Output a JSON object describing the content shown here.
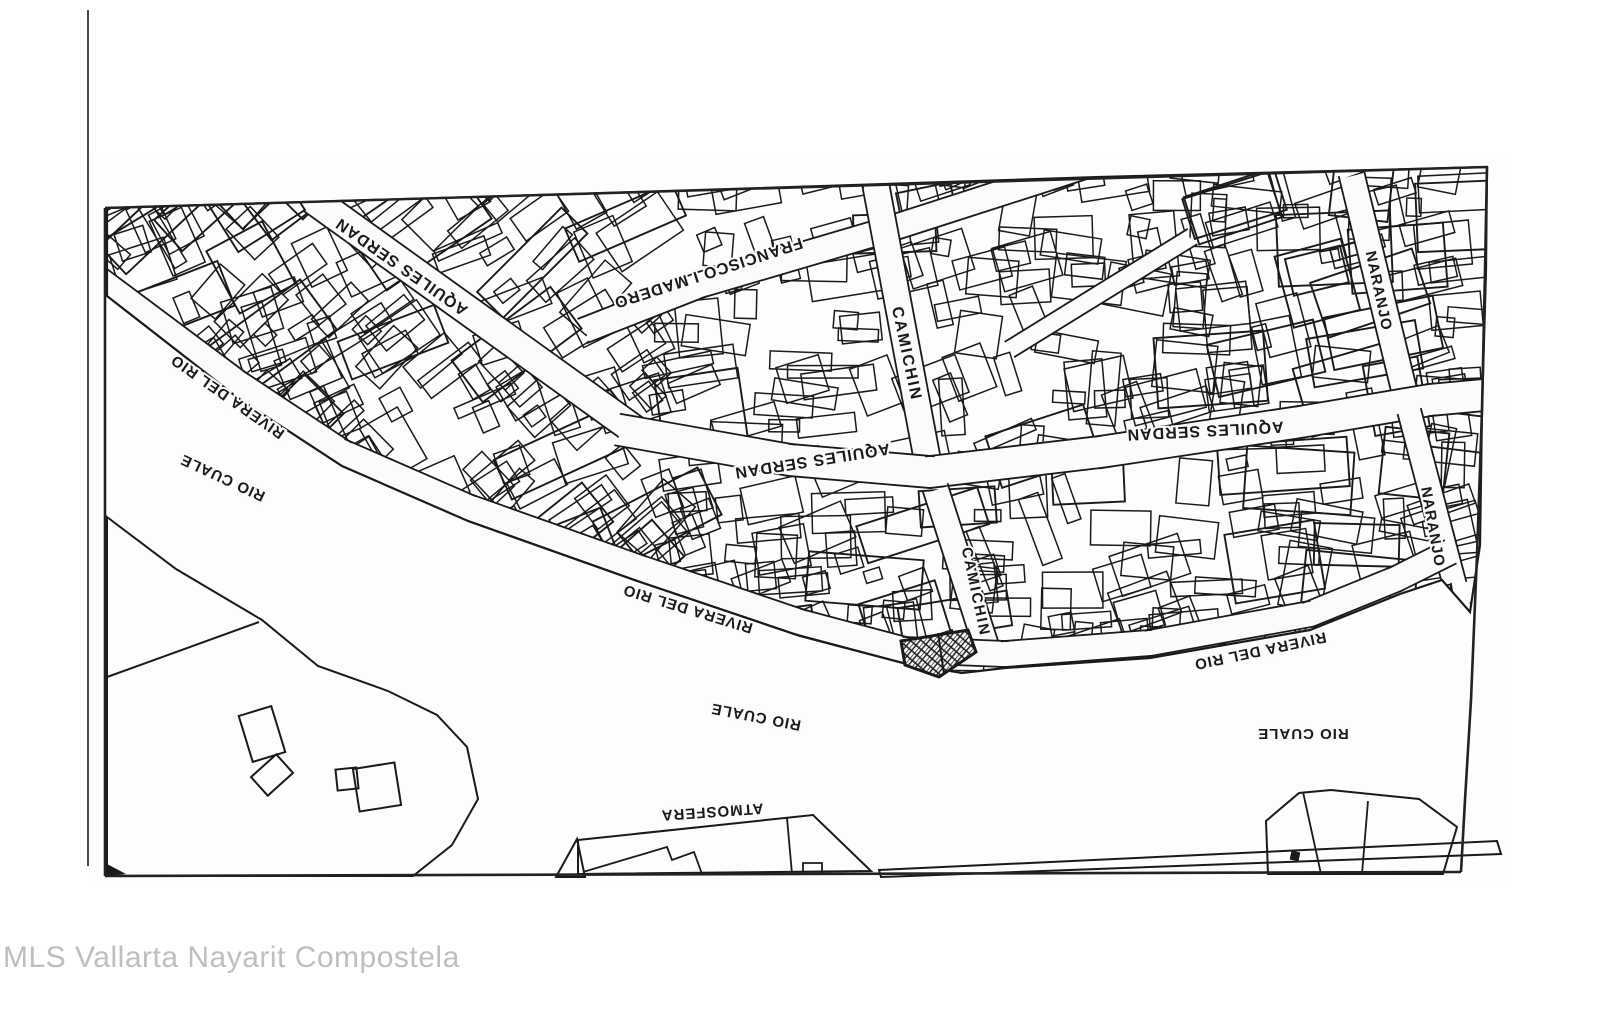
{
  "map": {
    "colors": {
      "ink": "#1a1a1a",
      "paper": "#fbfbfa",
      "frame": "#222222",
      "scan_edge": "#4a4a4a",
      "watermark": "#bfbfc1"
    },
    "watermark": {
      "text": "MLS Vallarta Nayarit Compostela"
    },
    "street_labels": [
      {
        "name": "aquiles-serdan-nw",
        "text": "AQUILES SERDAN",
        "x": 402,
        "y": 266,
        "rotation": 215,
        "size": 16,
        "spacing": 1
      },
      {
        "name": "francisco-i-madero",
        "text": "FRANCISCO I MADERO",
        "x": 708,
        "y": 272,
        "rotation": 162,
        "size": 16,
        "spacing": 1
      },
      {
        "name": "camichin-north",
        "text": "CAMICHIN",
        "x": 906,
        "y": 354,
        "rotation": 78,
        "size": 16,
        "spacing": 2
      },
      {
        "name": "aquiles-serdan-center",
        "text": "AQUILES SERDAN",
        "x": 812,
        "y": 460,
        "rotation": 171,
        "size": 16,
        "spacing": 1
      },
      {
        "name": "aquiles-serdan-east",
        "text": "AQUILES SERDAN",
        "x": 1205,
        "y": 430,
        "rotation": 177,
        "size": 16,
        "spacing": 1
      },
      {
        "name": "naranjo-north",
        "text": "NARANJO",
        "x": 1378,
        "y": 291,
        "rotation": 78,
        "size": 15,
        "spacing": 1
      },
      {
        "name": "naranjo-south",
        "text": "NARANJO",
        "x": 1432,
        "y": 527,
        "rotation": 80,
        "size": 15,
        "spacing": 1
      },
      {
        "name": "rivera-del-rio-west",
        "text": "RIVERA DEL RIO",
        "x": 228,
        "y": 396,
        "rotation": 215,
        "size": 15,
        "spacing": 1
      },
      {
        "name": "rio-cuale-west",
        "text": "RIO CUALE",
        "x": 223,
        "y": 477,
        "rotation": 205,
        "size": 15,
        "spacing": 1
      },
      {
        "name": "rivera-del-rio-center",
        "text": "RIVERA DEL RIO",
        "x": 688,
        "y": 608,
        "rotation": 197,
        "size": 15,
        "spacing": 1
      },
      {
        "name": "camichin-south",
        "text": "CAMICHIN",
        "x": 975,
        "y": 592,
        "rotation": 78,
        "size": 15,
        "spacing": 2
      },
      {
        "name": "rio-cuale-center",
        "text": "RIO CUALE",
        "x": 756,
        "y": 716,
        "rotation": 191,
        "size": 15,
        "spacing": 1
      },
      {
        "name": "rivera-del-rio-east",
        "text": "RIVERA DEL RIO",
        "x": 1260,
        "y": 650,
        "rotation": 168,
        "size": 15,
        "spacing": 1
      },
      {
        "name": "rio-cuale-east",
        "text": "RIO CUALE",
        "x": 1303,
        "y": 733,
        "rotation": 180,
        "size": 15,
        "spacing": 1
      },
      {
        "name": "atmosfera",
        "text": "ATMOSFERA",
        "x": 712,
        "y": 811,
        "rotation": 176,
        "size": 15,
        "spacing": 1
      }
    ],
    "highlighted_parcel": {
      "style": "crosshatch"
    }
  }
}
